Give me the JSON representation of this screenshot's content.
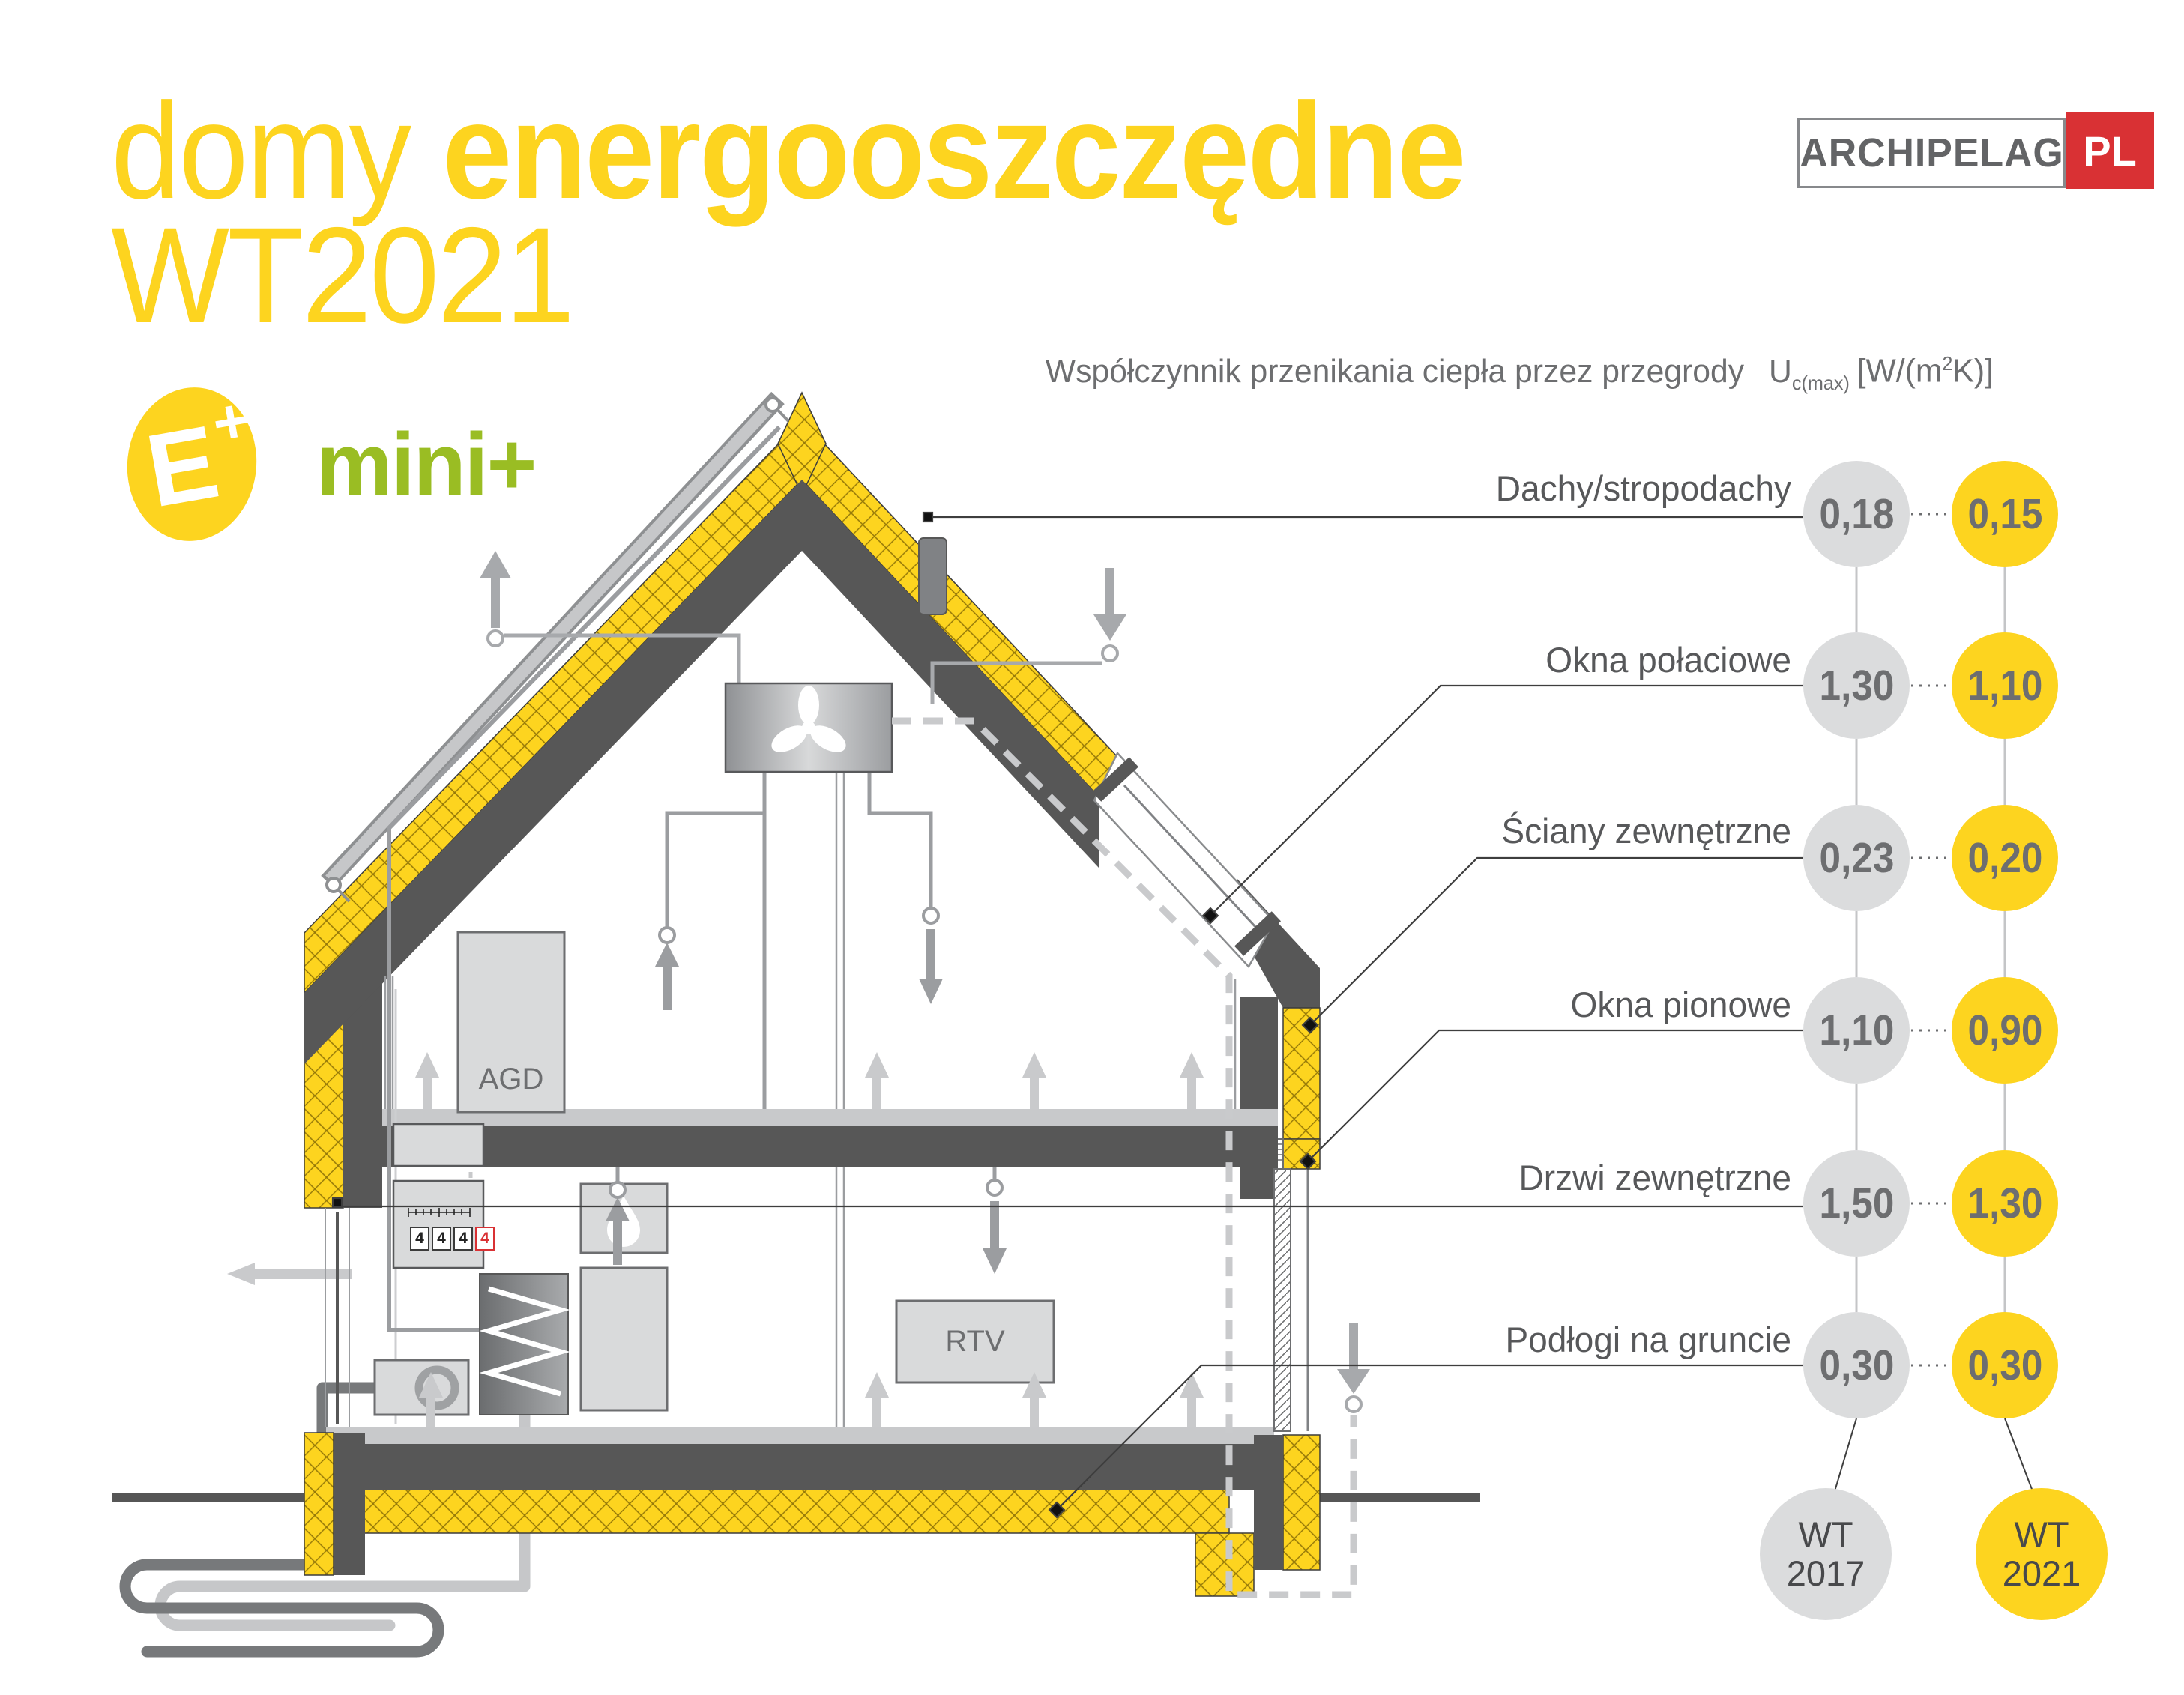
{
  "title": {
    "word_light": "domy",
    "word_bold": "energooszczędne",
    "line2": "WT2021"
  },
  "logo": {
    "name": "ARCHIPELAG",
    "tld": "PL"
  },
  "badges": {
    "e_letter": "E",
    "e_plus": "+",
    "program": "mini+"
  },
  "header": {
    "text": "Współczynnik przenikania ciepła przez przegrody",
    "u": "U",
    "u_sub": "c(max)",
    "unit_open": "[W/(m",
    "unit_sup": "2",
    "unit_close": "K)]"
  },
  "rows": [
    {
      "label": "Dachy/stropodachy",
      "wt2017": "0,18",
      "wt2021": "0,15"
    },
    {
      "label": "Okna połaciowe",
      "wt2017": "1,30",
      "wt2021": "1,10"
    },
    {
      "label": "Ściany zewnętrzne",
      "wt2017": "0,23",
      "wt2021": "0,20"
    },
    {
      "label": "Okna pionowe",
      "wt2017": "1,10",
      "wt2021": "0,90"
    },
    {
      "label": "Drzwi zewnętrzne",
      "wt2017": "1,50",
      "wt2021": "1,30"
    },
    {
      "label": "Podłogi na gruncie",
      "wt2017": "0,30",
      "wt2021": "0,30"
    }
  ],
  "columns": {
    "old": {
      "line1": "WT",
      "line2": "2017"
    },
    "new": {
      "line1": "WT",
      "line2": "2021"
    }
  },
  "house": {
    "appliances_label": "AGD",
    "tv_label": "RTV",
    "meter_digits": [
      "4",
      "4",
      "4",
      "4"
    ]
  },
  "colors": {
    "accent_yellow": "#FDD41F",
    "green": "#9ABD23",
    "red": "#D93134",
    "structure_dark": "#575757",
    "value_gray_circle": "#DBDCDD",
    "text_gray": "#6D6E70"
  }
}
